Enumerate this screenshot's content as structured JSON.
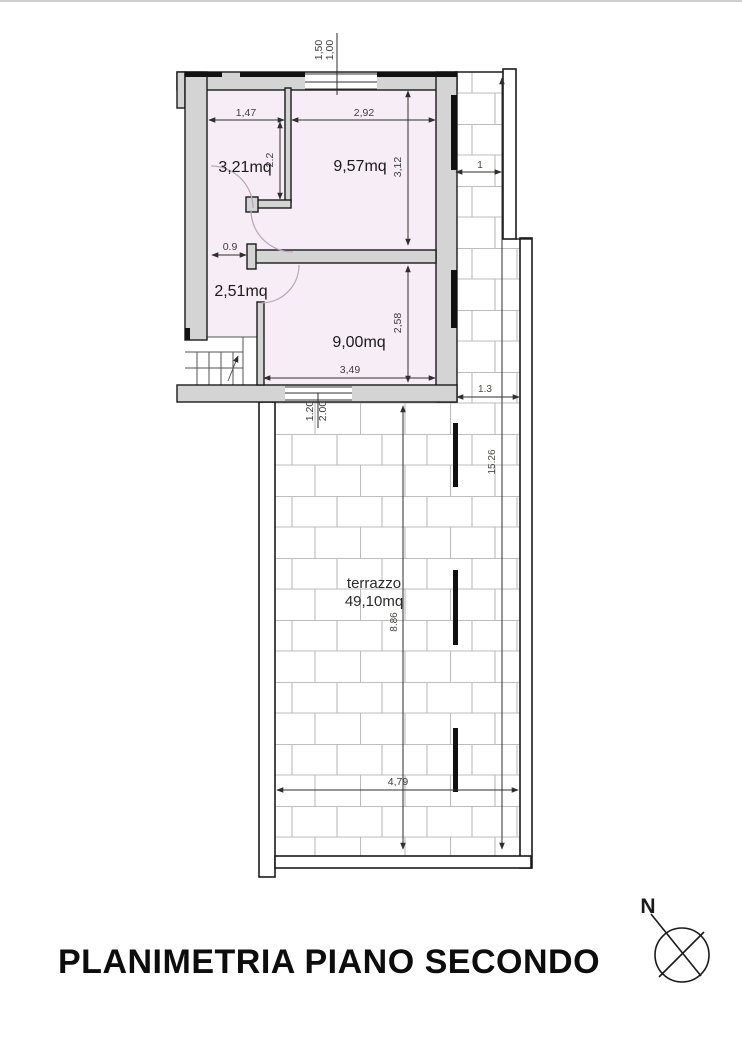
{
  "document": {
    "title": "PLANIMETRIA PIANO SECONDO"
  },
  "compass": {
    "north_label": "N"
  },
  "rooms": {
    "room_small_top_left": {
      "area": "3,21mq"
    },
    "room_top_right": {
      "area": "9,57mq"
    },
    "hallway": {
      "area": "2,51mq"
    },
    "room_bottom": {
      "area": "9,00mq"
    },
    "terrace": {
      "name": "terrazzo",
      "area": "49,10mq"
    }
  },
  "dimensions": {
    "top_window_a": "1,50",
    "top_window_b": "1,00",
    "room321_width": "1,47",
    "room957_width": "2,92",
    "room321_height": "2.2",
    "room957_height": "3,12",
    "hallway_width": "0.9",
    "room900_height": "2,58",
    "room900_width": "3,49",
    "terrace_door_a": "1.20",
    "terrace_door_b": "2.00",
    "balcony_width": "1",
    "balcony_width_lower": "1.3",
    "side_total_length": "15.26",
    "terrace_length": "8.86",
    "terrace_width": "4,79"
  },
  "colors": {
    "room_fill": "#f7edf7",
    "wall_fill": "#d4d4d4",
    "wall_line": "#1b1b1b",
    "brick_line": "#bdbdbd",
    "dim_color": "#3f3f3f"
  }
}
